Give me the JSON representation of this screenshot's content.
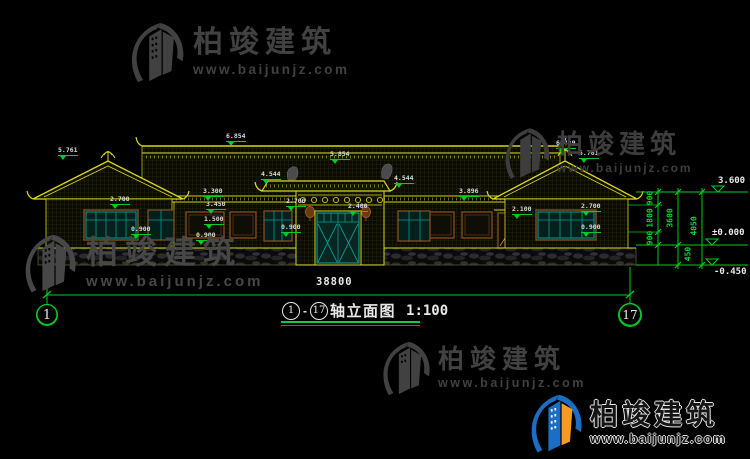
{
  "brand": {
    "name": "柏竣建筑",
    "url": "www.baijunjz.com"
  },
  "title_block": {
    "axis_from": "1",
    "separator": "-",
    "axis_to": "17",
    "title": "轴立面图",
    "scale": "1:100"
  },
  "axis_bubbles": {
    "left": "1",
    "right": "17"
  },
  "dimensions": {
    "total_width": "38800",
    "right_chain": [
      {
        "value": "900",
        "x": 650,
        "y": 198
      },
      {
        "value": "1800",
        "x": 650,
        "y": 218
      },
      {
        "value": "900",
        "x": 650,
        "y": 238
      },
      {
        "value": "3600",
        "x": 670,
        "y": 218
      },
      {
        "value": "4050",
        "x": 694,
        "y": 226
      },
      {
        "value": "450",
        "x": 688,
        "y": 254
      }
    ],
    "levels": [
      {
        "value": "3.600",
        "x": 718,
        "y": 176
      },
      {
        "value": "±0.000",
        "x": 712,
        "y": 228
      },
      {
        "value": "-0.450",
        "x": 714,
        "y": 267
      }
    ]
  },
  "elevation_markers": [
    {
      "value": "5.761",
      "x": 58,
      "y": 146
    },
    {
      "value": "2.700",
      "x": 110,
      "y": 195
    },
    {
      "value": "0.900",
      "x": 131,
      "y": 225
    },
    {
      "value": "6.854",
      "x": 226,
      "y": 132
    },
    {
      "value": "3.300",
      "x": 203,
      "y": 187
    },
    {
      "value": "3.450",
      "x": 206,
      "y": 200
    },
    {
      "value": "1.500",
      "x": 204,
      "y": 215
    },
    {
      "value": "0.900",
      "x": 196,
      "y": 231
    },
    {
      "value": "5.854",
      "x": 330,
      "y": 150
    },
    {
      "value": "4.544",
      "x": 261,
      "y": 170
    },
    {
      "value": "4.544",
      "x": 394,
      "y": 174
    },
    {
      "value": "2.700",
      "x": 286,
      "y": 197
    },
    {
      "value": "2.400",
      "x": 348,
      "y": 202
    },
    {
      "value": "0.900",
      "x": 281,
      "y": 223
    },
    {
      "value": "3.896",
      "x": 459,
      "y": 187
    },
    {
      "value": "2.100",
      "x": 512,
      "y": 205
    },
    {
      "value": "6.429",
      "x": 556,
      "y": 139
    },
    {
      "value": "5.761",
      "x": 579,
      "y": 149
    },
    {
      "value": "2.700",
      "x": 581,
      "y": 202
    },
    {
      "value": "0.900",
      "x": 581,
      "y": 223
    }
  ],
  "colors": {
    "background": "#000000",
    "cad_yellow": "#d8d81e",
    "cad_green": "#00cc22",
    "cad_teal": "#0a9a8e",
    "frame_brown": "#7a4a1e",
    "text_white": "#e8e8e8",
    "watermark_gray": "#414141",
    "logo_blue": "#1a6fc4",
    "logo_orange": "#f59a23"
  }
}
